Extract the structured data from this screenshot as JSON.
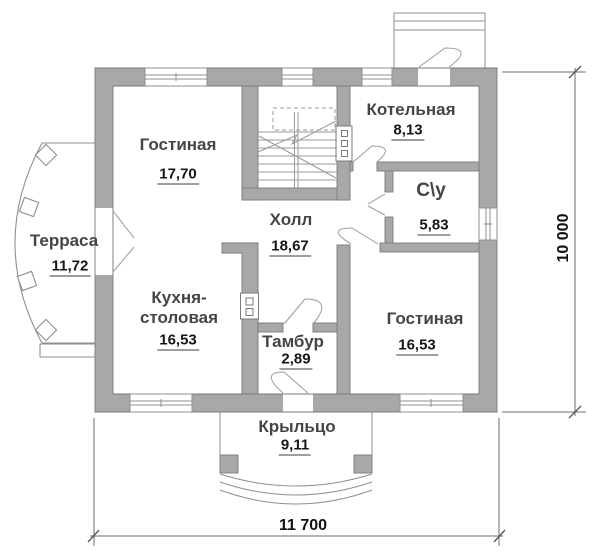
{
  "rooms": {
    "living_top": {
      "name": "Гостиная",
      "area": "17,70"
    },
    "terrace": {
      "name": "Терраса",
      "area": "11,72"
    },
    "boiler": {
      "name": "Котельная",
      "area": "8,13"
    },
    "wc": {
      "name": "С\\у",
      "area": "5,83"
    },
    "hall": {
      "name": "Холл",
      "area": "18,67"
    },
    "kitchen": {
      "name_line1": "Кухня-",
      "name_line2": "столовая",
      "area": "16,53"
    },
    "vestibule": {
      "name": "Тамбур",
      "area": "2,89"
    },
    "living_right": {
      "name": "Гостиная",
      "area": "16,53"
    },
    "porch": {
      "name": "Крыльцо",
      "area": "9,11"
    }
  },
  "dimensions": {
    "width_label": "11 700",
    "height_label": "10 000"
  },
  "colors": {
    "wall_fill": "#a8a8a8",
    "wall_edge": "#7a7a7a",
    "thin_line": "#8f8f8f"
  }
}
